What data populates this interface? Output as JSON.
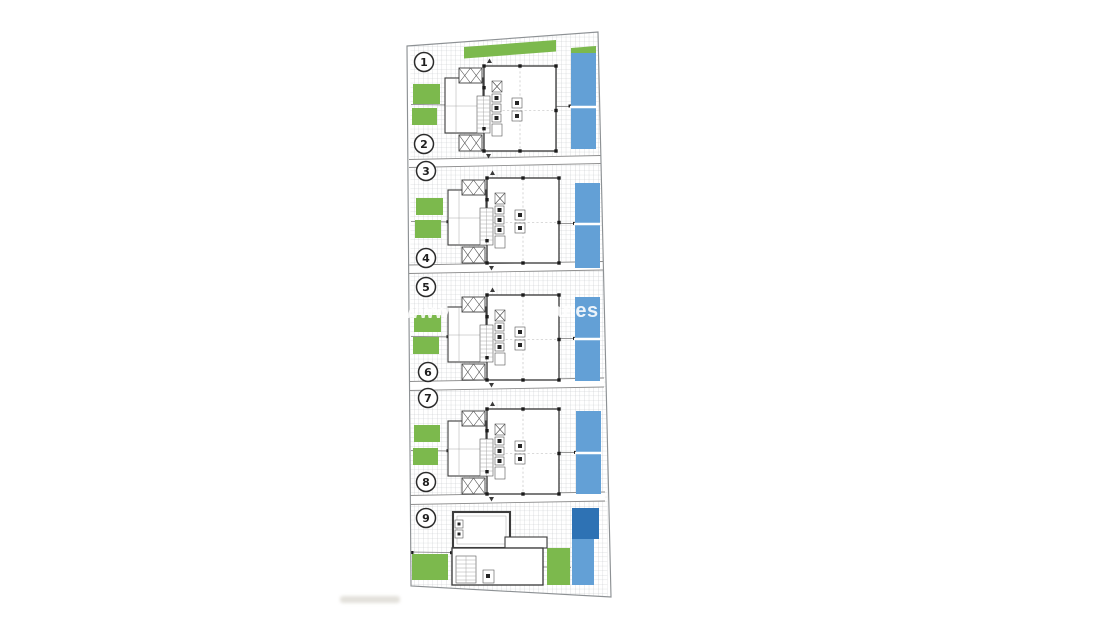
{
  "image": {
    "type": "architectural-site-plan",
    "background": "#ffffff"
  },
  "plan": {
    "units": [
      {
        "number": "1"
      },
      {
        "number": "2"
      },
      {
        "number": "3"
      },
      {
        "number": "4"
      },
      {
        "number": "5"
      },
      {
        "number": "6"
      },
      {
        "number": "7"
      },
      {
        "number": "8"
      },
      {
        "number": "9"
      }
    ],
    "blocks": [
      {
        "type": "semi-detached-pair",
        "units": "1-2",
        "features": "two gardens, shared pool split in two"
      },
      {
        "type": "semi-detached-pair",
        "units": "3-4",
        "features": "two gardens, shared pool split in two"
      },
      {
        "type": "semi-detached-pair",
        "units": "5-6",
        "features": "two gardens, shared pool split in two"
      },
      {
        "type": "semi-detached-pair",
        "units": "7-8",
        "features": "two gardens, shared pool split in two"
      },
      {
        "type": "detached-villa",
        "units": "9",
        "features": "two gardens, dark pool and terrace"
      }
    ],
    "colors": {
      "garden": "#7cb94d",
      "pool": "#63a0d6",
      "pool_dark": "#2e72b4",
      "wall": "#3c3c3c",
      "boundary": "#8d9194",
      "grid_line": "#c2c5c8",
      "watermark": "#ffffff"
    },
    "watermark": {
      "fragment_left": "www",
      "fragment_right": "anes"
    }
  }
}
